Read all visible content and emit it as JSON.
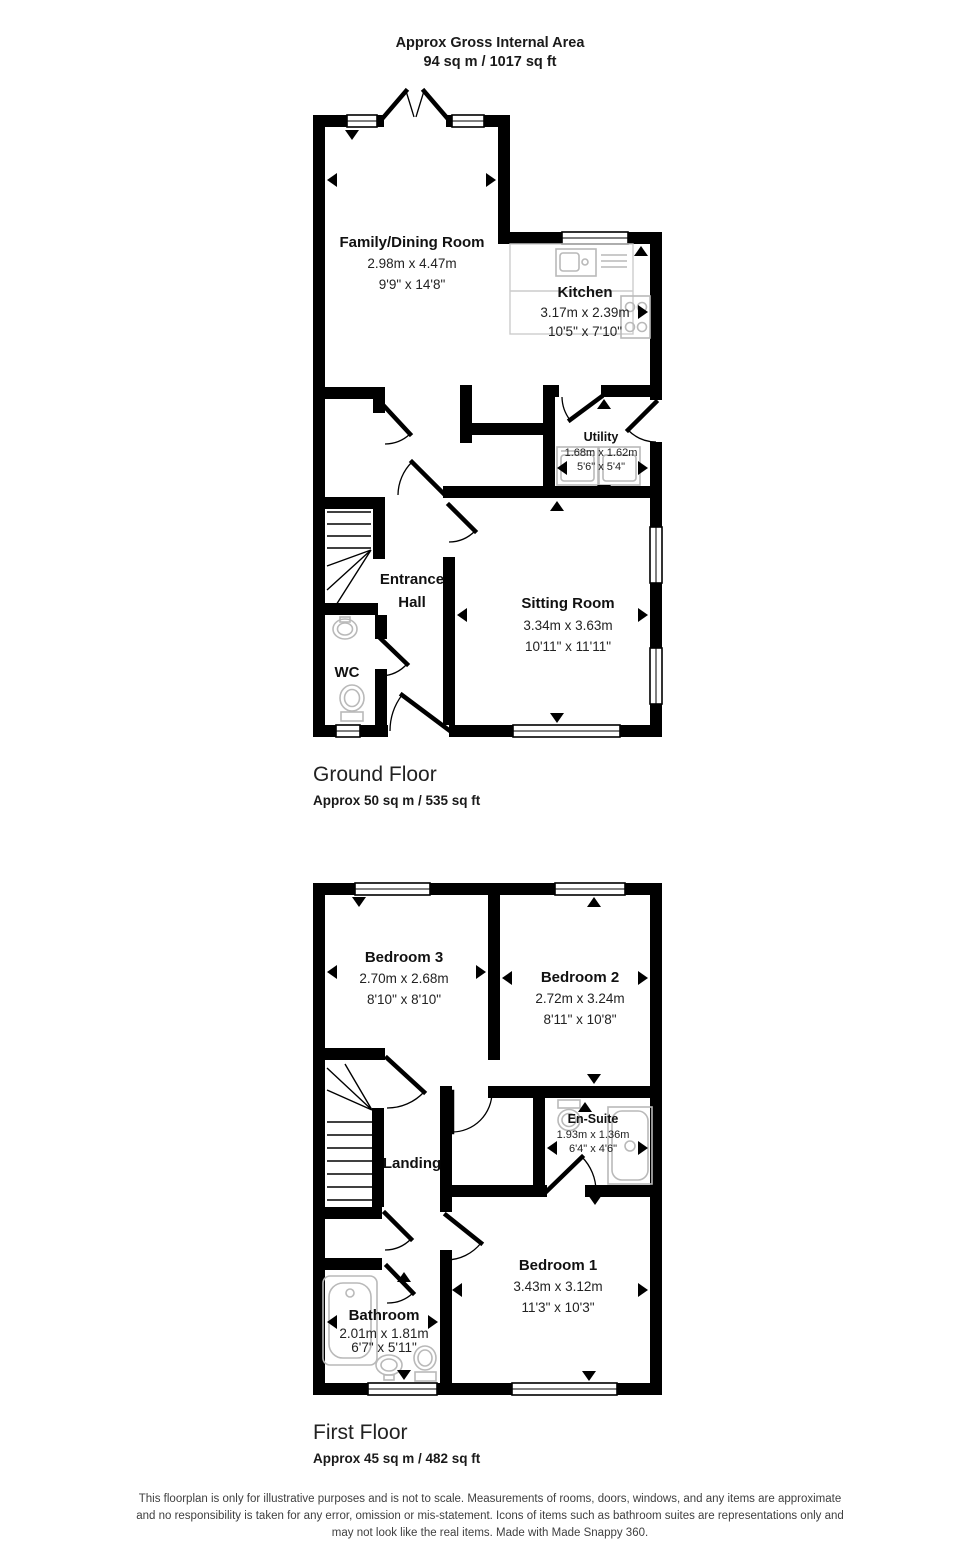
{
  "header": {
    "line1": "Approx Gross Internal Area",
    "line2": "94 sq m / 1017 sq ft"
  },
  "ground_floor": {
    "title": "Ground Floor",
    "area": "Approx 50 sq m / 535 sq ft",
    "rooms": {
      "family_dining": {
        "name": "Family/Dining Room",
        "metric": "2.98m x 4.47m",
        "imperial": "9'9\" x 14'8\""
      },
      "kitchen": {
        "name": "Kitchen",
        "metric": "3.17m x 2.39m",
        "imperial": "10'5\" x 7'10\""
      },
      "utility": {
        "name": "Utility",
        "metric": "1.68m x 1.62m",
        "imperial": "5'6\" x 5'4\""
      },
      "entrance_hall": {
        "line1": "Entrance",
        "line2": "Hall"
      },
      "sitting_room": {
        "name": "Sitting Room",
        "metric": "3.34m x 3.63m",
        "imperial": "10'11\" x 11'11\""
      },
      "wc": {
        "name": "WC"
      }
    }
  },
  "first_floor": {
    "title": "First Floor",
    "area": "Approx 45 sq m / 482 sq ft",
    "rooms": {
      "bedroom3": {
        "name": "Bedroom 3",
        "metric": "2.70m x 2.68m",
        "imperial": "8'10\" x 8'10\""
      },
      "bedroom2": {
        "name": "Bedroom 2",
        "metric": "2.72m x 3.24m",
        "imperial": "8'11\" x 10'8\""
      },
      "ensuite": {
        "name": "En-Suite",
        "metric": "1.93m x 1.36m",
        "imperial": "6'4\" x 4'6\""
      },
      "landing": {
        "name": "Landing"
      },
      "bedroom1": {
        "name": "Bedroom 1",
        "metric": "3.43m x 3.12m",
        "imperial": "11'3\" x 10'3\""
      },
      "bathroom": {
        "name": "Bathroom",
        "metric": "2.01m x 1.81m",
        "imperial": "6'7\" x 5'11\""
      }
    }
  },
  "disclaimer": {
    "line1": "This floorplan is only for illustrative purposes and is not to scale. Measurements of rooms, doors, windows, and any items are approximate",
    "line2": "and no responsibility is taken for any error, omission or mis-statement. Icons of items such as bathroom suites are representations only and",
    "line3": "may not look like the real items. Made with Made Snappy 360."
  },
  "colors": {
    "wall": "#000000",
    "fixture": "#b9b9b9",
    "counter": "#cccccc",
    "text": "#1a1a1a"
  }
}
